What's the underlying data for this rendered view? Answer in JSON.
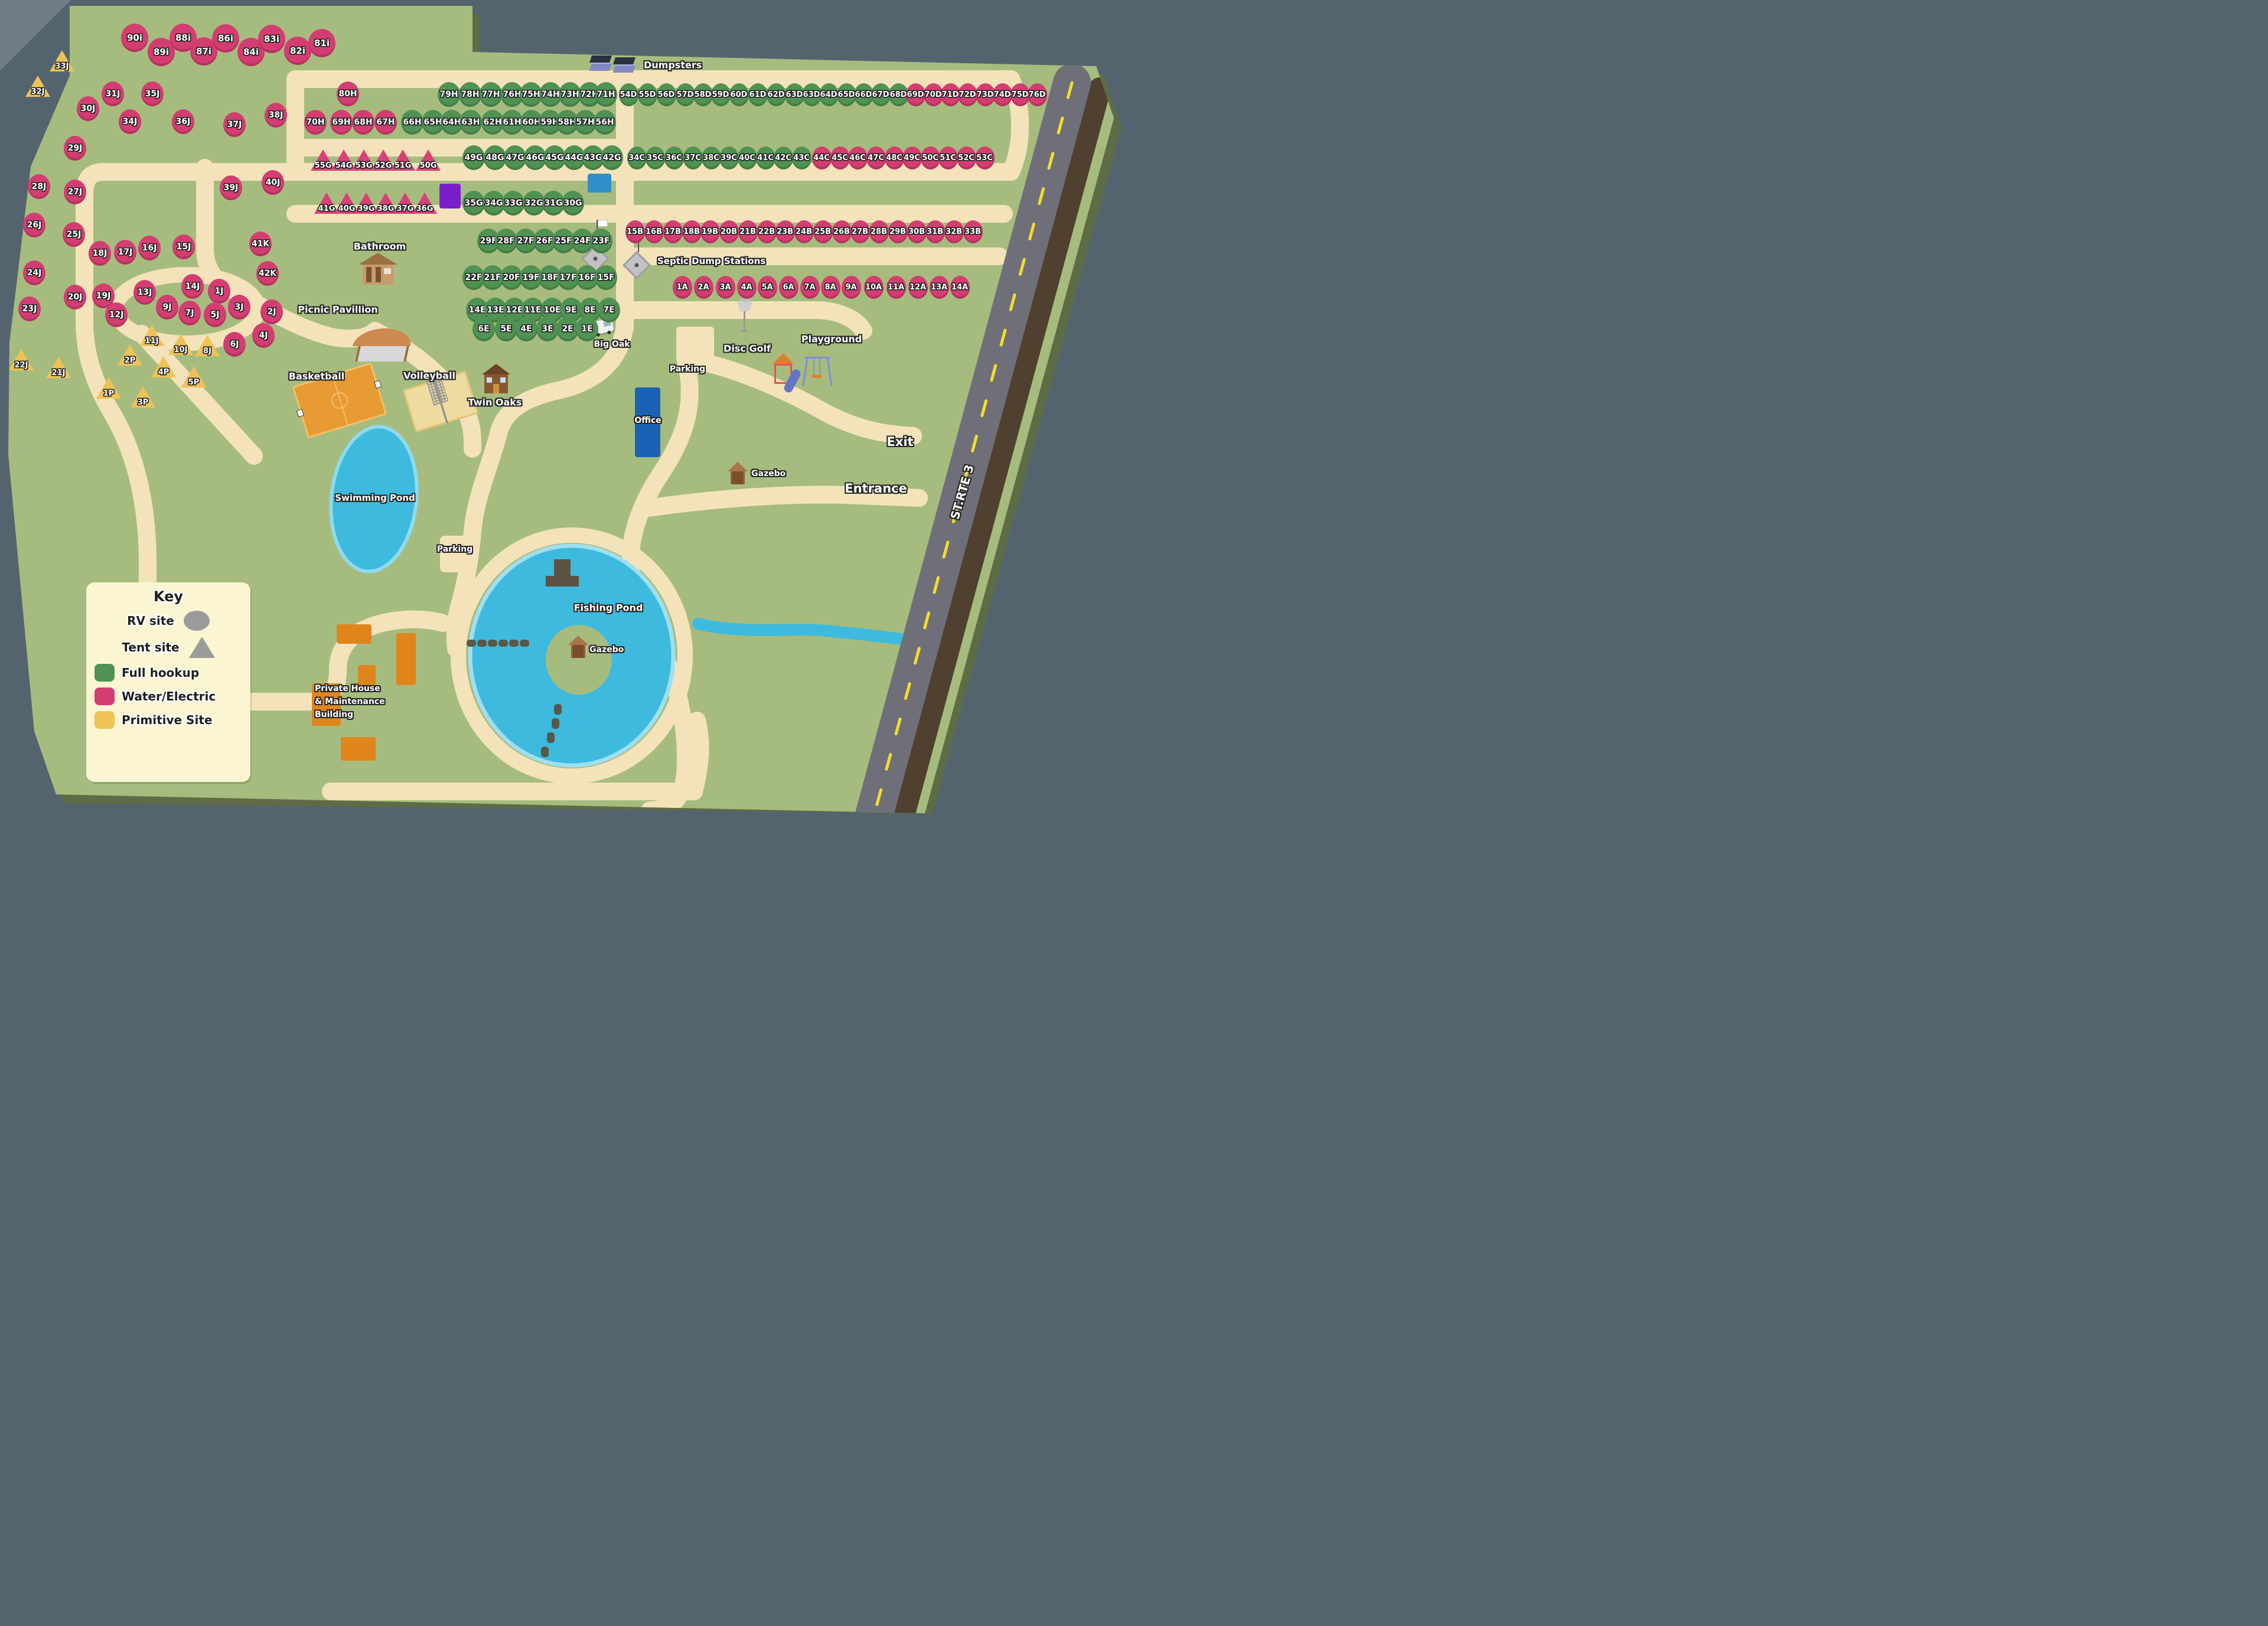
{
  "legend": {
    "title": "Key",
    "rv_label": "RV site",
    "tent_label": "Tent site",
    "full_label": "Full hookup",
    "water_electric_label": "Water/Electric",
    "primitive_label": "Primitive Site"
  },
  "labels": {
    "dumpsters": "Dumpsters",
    "bathroom": "Bathroom",
    "picnic": "Picnic Pavillion",
    "basketball": "Basketball",
    "volleyball": "Volleyball",
    "twin_oaks": "Twin Oaks",
    "swimming_pond": "Swimming Pond",
    "parking_pond": "Parking",
    "parking_north": "Parking",
    "office": "Office",
    "big_oak": "Big Oak",
    "septic": "Septic Dump Stations",
    "disc_golf": "Disc Golf",
    "playground": "Playground",
    "gazebo_east": "Gazebo",
    "gazebo_island": "Gazebo",
    "exit": "Exit",
    "entrance": "Entrance",
    "route": "ST.RTE 3",
    "fishing_pond": "Fishing Pond",
    "private_house_l1": "Private House",
    "private_house_l2": "& Maintenance",
    "private_house_l3": "Building"
  },
  "colors": {
    "map_green": "#a6bc7e",
    "road_tan": "#f4e3ba",
    "water_blue": "#3dbade",
    "full_hookup": "#4f9254",
    "water_electric": "#d43d72",
    "primitive": "#eec257",
    "office_blue": "#1a62b5",
    "building_orange": "#e0851c",
    "purple_building": "#7a1ec9",
    "pool_blue": "#2f8fc6"
  },
  "site_groups": [
    {
      "shape": "ellipse",
      "type": "we",
      "size": "lg",
      "sites": [
        [
          "90i",
          228,
          64
        ],
        [
          "89i",
          273,
          88
        ],
        [
          "88i",
          310,
          64
        ],
        [
          "87i",
          345,
          87
        ],
        [
          "86i",
          382,
          65
        ],
        [
          "84i",
          425,
          88
        ],
        [
          "83i",
          460,
          66
        ],
        [
          "82i",
          504,
          86
        ],
        [
          "81i",
          545,
          73
        ]
      ]
    },
    {
      "shape": "ellipse",
      "type": "we",
      "size": "md",
      "sites": [
        [
          "80H",
          589,
          159
        ],
        [
          "70H",
          534,
          207
        ],
        [
          "69H",
          578,
          207
        ],
        [
          "68H",
          615,
          207
        ],
        [
          "67H",
          653,
          207
        ],
        [
          "31J",
          191,
          159
        ],
        [
          "35J",
          258,
          159
        ],
        [
          "30J",
          149,
          184
        ],
        [
          "34J",
          220,
          206
        ],
        [
          "36J",
          310,
          206
        ],
        [
          "37J",
          397,
          211
        ],
        [
          "38J",
          467,
          195
        ],
        [
          "29J",
          127,
          251
        ],
        [
          "39J",
          391,
          318
        ],
        [
          "40J",
          462,
          309
        ],
        [
          "28J",
          66,
          316
        ],
        [
          "27J",
          127,
          325
        ],
        [
          "26J",
          58,
          381
        ],
        [
          "25J",
          125,
          397
        ],
        [
          "41K",
          441,
          413
        ],
        [
          "18J",
          169,
          429
        ],
        [
          "17J",
          212,
          427
        ],
        [
          "16J",
          253,
          420
        ],
        [
          "15J",
          311,
          418
        ],
        [
          "42K",
          453,
          463
        ],
        [
          "24J",
          58,
          462
        ],
        [
          "13J",
          245,
          495
        ],
        [
          "14J",
          326,
          485
        ],
        [
          "1J",
          371,
          493
        ],
        [
          "20J",
          127,
          503
        ],
        [
          "19J",
          175,
          501
        ],
        [
          "9J",
          283,
          520
        ],
        [
          "7J",
          321,
          530
        ],
        [
          "5J",
          364,
          533
        ],
        [
          "3J",
          405,
          520
        ],
        [
          "2J",
          460,
          528
        ],
        [
          "12J",
          197,
          533
        ],
        [
          "23J",
          50,
          523
        ],
        [
          "4J",
          446,
          568
        ],
        [
          "6J",
          397,
          583
        ]
      ]
    },
    {
      "shape": "ellipse",
      "type": "full",
      "size": "md",
      "sites": [
        [
          "79H",
          760,
          160
        ],
        [
          "78H",
          796,
          160
        ],
        [
          "77H",
          831,
          160
        ],
        [
          "76H",
          867,
          160
        ],
        [
          "75H",
          899,
          160
        ],
        [
          "74H",
          932,
          160
        ],
        [
          "73H",
          965,
          160
        ],
        [
          "72H",
          998,
          160
        ],
        [
          "71H",
          1026,
          160
        ],
        [
          "66H",
          698,
          207
        ],
        [
          "65H",
          733,
          207
        ],
        [
          "64H",
          765,
          207
        ],
        [
          "63H",
          797,
          207
        ],
        [
          "62H",
          834,
          207
        ],
        [
          "61H",
          867,
          207
        ],
        [
          "60H",
          900,
          207
        ],
        [
          "59H",
          931,
          207
        ],
        [
          "58H",
          960,
          207
        ],
        [
          "57H",
          991,
          207
        ],
        [
          "56H",
          1024,
          207
        ],
        [
          "49G",
          802,
          267
        ],
        [
          "48G",
          838,
          267
        ],
        [
          "47G",
          872,
          267
        ],
        [
          "46G",
          906,
          267
        ],
        [
          "45G",
          939,
          267
        ],
        [
          "44G",
          972,
          267
        ],
        [
          "43G",
          1004,
          267
        ],
        [
          "42G",
          1036,
          267
        ],
        [
          "35G",
          802,
          344
        ],
        [
          "34G",
          836,
          344
        ],
        [
          "33G",
          869,
          344
        ],
        [
          "32G",
          904,
          344
        ],
        [
          "31G",
          937,
          344
        ],
        [
          "30G",
          970,
          344
        ],
        [
          "29F",
          827,
          408
        ],
        [
          "28F",
          857,
          408
        ],
        [
          "27F",
          890,
          408
        ],
        [
          "26F",
          922,
          408
        ],
        [
          "25F",
          954,
          408
        ],
        [
          "24F",
          986,
          408
        ],
        [
          "23F",
          1018,
          408
        ],
        [
          "22F",
          802,
          470
        ],
        [
          "21F",
          834,
          470
        ],
        [
          "20F",
          866,
          470
        ],
        [
          "19F",
          899,
          470
        ],
        [
          "18F",
          931,
          470
        ],
        [
          "17F",
          962,
          470
        ],
        [
          "16F",
          994,
          470
        ],
        [
          "15F",
          1026,
          470
        ],
        [
          "14E",
          808,
          525
        ],
        [
          "13E",
          839,
          525
        ],
        [
          "12E",
          871,
          525
        ],
        [
          "11E",
          902,
          525
        ],
        [
          "10E",
          935,
          525
        ],
        [
          "9E",
          967,
          525
        ],
        [
          "8E",
          999,
          525
        ],
        [
          "7E",
          1031,
          525
        ],
        [
          "6E",
          819,
          557
        ],
        [
          "5E",
          857,
          557
        ],
        [
          "4E",
          891,
          557
        ],
        [
          "3E",
          927,
          557
        ],
        [
          "2E",
          961,
          557
        ],
        [
          "1E",
          994,
          557
        ]
      ]
    },
    {
      "shape": "ellipse",
      "type": "full",
      "size": "sm",
      "sites": [
        [
          "54D",
          1064,
          160
        ],
        [
          "55D",
          1096,
          160
        ],
        [
          "56D",
          1128,
          160
        ],
        [
          "57D",
          1160,
          160
        ],
        [
          "58D",
          1190,
          160
        ],
        [
          "59D",
          1220,
          160
        ],
        [
          "60D",
          1251,
          160
        ],
        [
          "61D",
          1283,
          160
        ],
        [
          "62D",
          1314,
          160
        ],
        [
          "63D",
          1345,
          160
        ],
        [
          "63D",
          1374,
          160
        ],
        [
          "64D",
          1403,
          160
        ],
        [
          "65D",
          1433,
          160
        ],
        [
          "66D",
          1462,
          160
        ],
        [
          "67D",
          1491,
          160
        ],
        [
          "68D",
          1521,
          160
        ],
        [
          "34C",
          1078,
          267
        ],
        [
          "35C",
          1109,
          267
        ],
        [
          "36C",
          1141,
          267
        ],
        [
          "37C",
          1173,
          267
        ],
        [
          "38C",
          1204,
          267
        ],
        [
          "39C",
          1234,
          267
        ],
        [
          "40C",
          1265,
          267
        ],
        [
          "41C",
          1296,
          267
        ],
        [
          "42C",
          1326,
          267
        ],
        [
          "43C",
          1357,
          267
        ]
      ]
    },
    {
      "shape": "ellipse",
      "type": "we",
      "size": "sm",
      "sites": [
        [
          "69D",
          1550,
          160
        ],
        [
          "70D",
          1580,
          160
        ],
        [
          "71D",
          1609,
          160
        ],
        [
          "72D",
          1638,
          160
        ],
        [
          "73D",
          1668,
          160
        ],
        [
          "74D",
          1697,
          160
        ],
        [
          "75D",
          1727,
          160
        ],
        [
          "76D",
          1756,
          160
        ],
        [
          "44C",
          1391,
          267
        ],
        [
          "45C",
          1422,
          267
        ],
        [
          "46C",
          1452,
          267
        ],
        [
          "47C",
          1483,
          267
        ],
        [
          "48C",
          1514,
          267
        ],
        [
          "49C",
          1544,
          267
        ],
        [
          "50C",
          1575,
          267
        ],
        [
          "51C",
          1605,
          267
        ],
        [
          "52C",
          1636,
          267
        ],
        [
          "53C",
          1667,
          267
        ],
        [
          "15B",
          1075,
          392
        ],
        [
          "16B",
          1107,
          392
        ],
        [
          "17B",
          1139,
          392
        ],
        [
          "18B",
          1171,
          392
        ],
        [
          "19B",
          1202,
          392
        ],
        [
          "20B",
          1234,
          392
        ],
        [
          "21B",
          1266,
          392
        ],
        [
          "22B",
          1298,
          392
        ],
        [
          "23B",
          1329,
          392
        ],
        [
          "24B",
          1361,
          392
        ],
        [
          "25B",
          1393,
          392
        ],
        [
          "26B",
          1425,
          392
        ],
        [
          "27B",
          1456,
          392
        ],
        [
          "28B",
          1488,
          392
        ],
        [
          "29B",
          1520,
          392
        ],
        [
          "30B",
          1552,
          392
        ],
        [
          "31B",
          1583,
          392
        ],
        [
          "32B",
          1615,
          392
        ],
        [
          "33B",
          1647,
          392
        ],
        [
          "1A",
          1155,
          486
        ],
        [
          "2A",
          1191,
          486
        ],
        [
          "3A",
          1228,
          486
        ],
        [
          "4A",
          1264,
          486
        ],
        [
          "5A",
          1299,
          486
        ],
        [
          "6A",
          1335,
          486
        ],
        [
          "7A",
          1371,
          486
        ],
        [
          "8A",
          1406,
          486
        ],
        [
          "9A",
          1441,
          486
        ],
        [
          "10A",
          1479,
          486
        ],
        [
          "11A",
          1517,
          486
        ],
        [
          "12A",
          1554,
          486
        ],
        [
          "13A",
          1590,
          486
        ],
        [
          "14A",
          1625,
          486
        ]
      ]
    },
    {
      "shape": "triangle",
      "type": "we",
      "size": "md",
      "sites": [
        [
          "55G",
          547,
          271
        ],
        [
          "54G",
          582,
          271
        ],
        [
          "53G",
          616,
          271
        ],
        [
          "52G",
          649,
          271
        ],
        [
          "51G",
          682,
          271
        ],
        [
          "50G",
          725,
          271
        ],
        [
          "41G",
          553,
          344
        ],
        [
          "40G",
          587,
          344
        ],
        [
          "39G",
          620,
          344
        ],
        [
          "38G",
          653,
          344
        ],
        [
          "37G",
          686,
          344
        ],
        [
          "36G",
          719,
          344
        ]
      ]
    },
    {
      "shape": "triangle",
      "type": "prim",
      "size": "md",
      "sites": [
        [
          "33J",
          105,
          103
        ],
        [
          "32J",
          64,
          146
        ],
        [
          "22J",
          36,
          609
        ],
        [
          "21J",
          99,
          622
        ],
        [
          "11J",
          257,
          568
        ],
        [
          "10J",
          306,
          583
        ],
        [
          "8J",
          351,
          585
        ],
        [
          "2P",
          220,
          601
        ],
        [
          "4P",
          277,
          621
        ],
        [
          "5P",
          328,
          638
        ],
        [
          "1P",
          184,
          657
        ],
        [
          "3P",
          242,
          672
        ]
      ]
    }
  ]
}
